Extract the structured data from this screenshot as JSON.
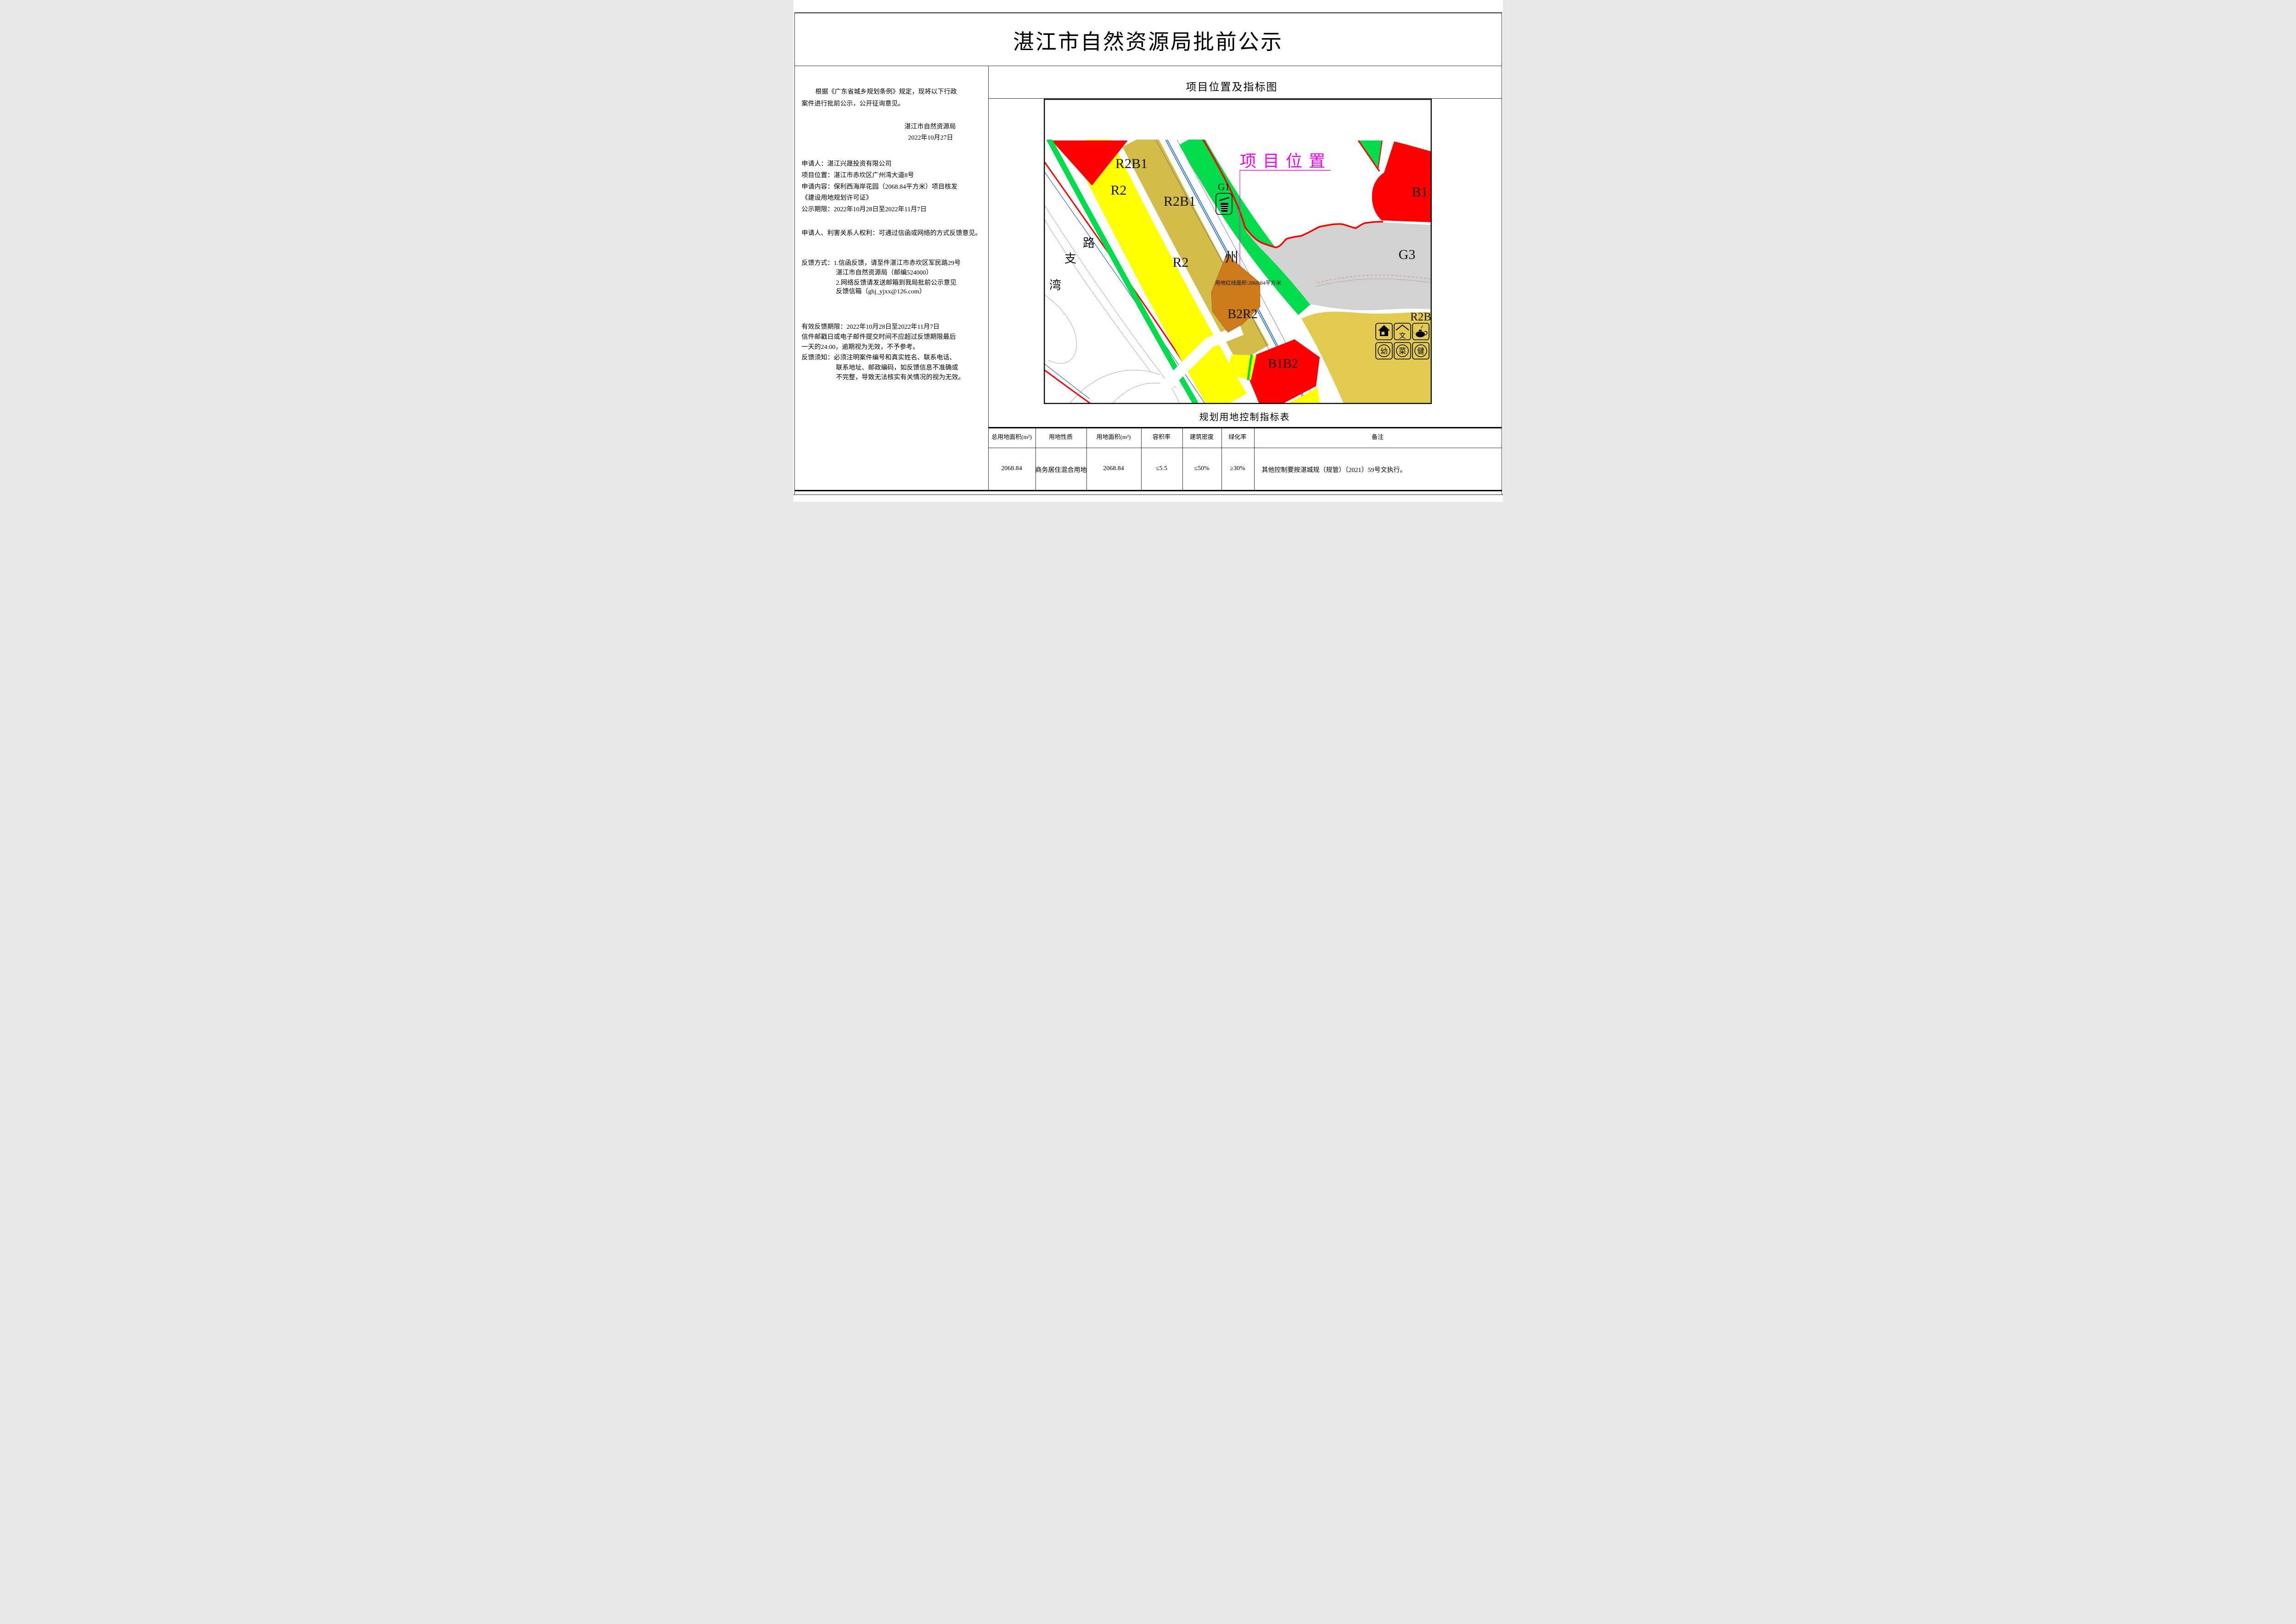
{
  "doc_title": "湛江市自然资源局批前公示",
  "left_panel": {
    "lines": [
      "根据《广东省城乡规划条例》规定，现将以下行政",
      "案件进行批前公示，公开征询意见。",
      "湛江市自然资源局",
      "2022年10月27日",
      "申请人：湛江兴晟投资有限公司",
      "项目位置：湛江市赤坎区广州湾大道8号",
      "申请内容：保利西海岸花园（2068.84平方米）项目核发",
      "《建设用地规划许可证》",
      "公示期限：2022年10月28日至2022年11月7日",
      "申请人、利害关系人权利：可通过信函或网络的方式反馈意见。",
      "反馈方式：1.信函反馈，请至件湛江市赤坎区军民路29号",
      "湛江市自然资源局（邮编524000）",
      "2.网络反馈请发送邮箱到我局批前公示意见",
      "反馈信箱（ghj_yjxx@126.com）",
      "有效反馈期限：2022年10月28日至2022年11月7日",
      "信件邮戳日或电子邮件提交时间不应超过反馈期限最后",
      "一天的24:00，逾期视为无效，不予参考。",
      "反馈须知：必须注明案件编号和真实姓名、联系电话、",
      "联系地址、邮政编码，如反馈信息不准确或",
      "不完整，导致无法核实有关情况的视为无效。"
    ]
  },
  "map_panel": {
    "heading": "项目位置及指标图",
    "labels": {
      "project_location": "项目位置",
      "red_line_note": "用地红线面积:2068.84平方米",
      "r2b1_a": "R2B1",
      "r2_a": "R2",
      "r2b1_b": "R2B1",
      "r2_b": "R2",
      "b2r2": "B2R2",
      "b1b2": "B1B2",
      "g1": "G1",
      "g3": "G3",
      "b1": "B1",
      "r2b": "R2B",
      "road_zhou": "州",
      "road_lu": "路",
      "road_zhi": "支",
      "road_wan": "湾",
      "facility_wen": "文",
      "facility_you": "幼",
      "facility_cai": "菜",
      "facility_jian": "健"
    },
    "colors": {
      "residential_yellow": "#FFFF00",
      "mixed_tan": "#D4BC4A",
      "r2b_khaki": "#E2CB50",
      "commercial_red": "#FF0000",
      "green_space": "#00DC4B",
      "b2r2_orange": "#CE7B1C",
      "g3_gray": "#D2D2D2",
      "road_blue": "#1565D8",
      "annotation_magenta": "#FF00FF"
    }
  },
  "table": {
    "title": "规划用地控制指标表",
    "headers": [
      "总用地面积(m²)",
      "用地性质",
      "用地面积(m²)",
      "容积率",
      "建筑密度",
      "绿化率",
      "备注"
    ],
    "row": [
      "2068.84",
      "商务居住混合用地",
      "2068.84",
      "≤5.5",
      "≤50%",
      "≥30%",
      "其他控制要按湛城规（规管）〔2021〕59号文执行。"
    ]
  }
}
